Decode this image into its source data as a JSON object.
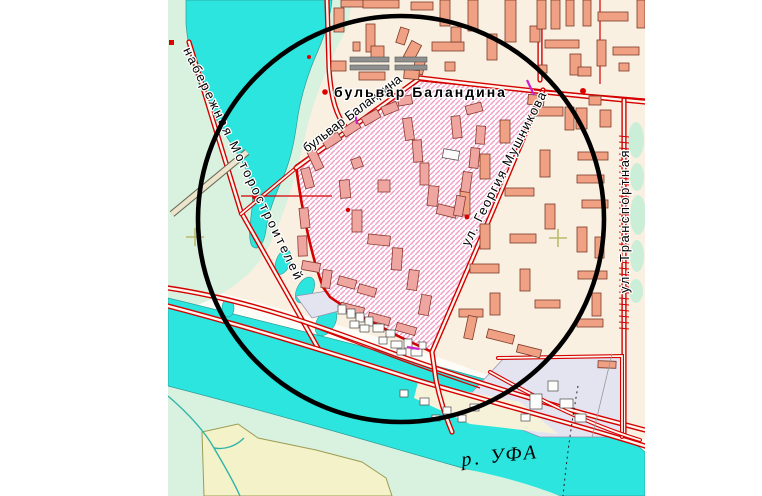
{
  "map": {
    "labels": {
      "embankment": "набережная Моторостроителей",
      "balandina_diagonal": "бульвар Баландина",
      "balandina_horizontal": "бульвар Баландина",
      "mushnikova": "ул. Георгия Мушникова",
      "transportnaya": "ул. Транспортная",
      "river": "р. УФА"
    },
    "colors": {
      "water": "#2BE5DE",
      "park_green": "#D9F1DF",
      "urban_cream": "#FAF0E1",
      "building_salmon": "#F0A183",
      "building_pink_zone": "#EFA6A0",
      "hatch_stripe_pink": "#F2A0C8",
      "selection_border_red": "#D40000",
      "road_red": "#D40000",
      "industrial_lavender": "#E4E3F0",
      "field_yellow": "#F4F2C8",
      "selection_circle": "#000000"
    },
    "buildings": {
      "salmon": [
        [
          334,
          8,
          10,
          24,
          0
        ],
        [
          341,
          0,
          28,
          7,
          0
        ],
        [
          363,
          0,
          36,
          8,
          0
        ],
        [
          366,
          24,
          9,
          28,
          0
        ],
        [
          371,
          46,
          13,
          13,
          0
        ],
        [
          353,
          42,
          7,
          9,
          0
        ],
        [
          331,
          61,
          15,
          10,
          0
        ],
        [
          359,
          72,
          26,
          8,
          0
        ],
        [
          398,
          28,
          9,
          16,
          18
        ],
        [
          407,
          42,
          11,
          18,
          28
        ],
        [
          414,
          60,
          10,
          14,
          12
        ],
        [
          404,
          70,
          15,
          9,
          5
        ],
        [
          411,
          2,
          22,
          8,
          0
        ],
        [
          440,
          0,
          10,
          26,
          0
        ],
        [
          432,
          42,
          32,
          9,
          0
        ],
        [
          451,
          27,
          10,
          15,
          0
        ],
        [
          468,
          0,
          10,
          31,
          0
        ],
        [
          487,
          34,
          10,
          26,
          0
        ],
        [
          505,
          0,
          11,
          42,
          0
        ],
        [
          530,
          26,
          10,
          16,
          0
        ],
        [
          445,
          62,
          10,
          9,
          0
        ],
        [
          537,
          0,
          9,
          29,
          0
        ],
        [
          551,
          0,
          9,
          29,
          0
        ],
        [
          566,
          0,
          8,
          26,
          0
        ],
        [
          583,
          0,
          8,
          26,
          0
        ],
        [
          598,
          12,
          30,
          9,
          0
        ],
        [
          637,
          0,
          8,
          28,
          0
        ],
        [
          545,
          40,
          34,
          8,
          0
        ],
        [
          597,
          40,
          9,
          26,
          0
        ],
        [
          613,
          47,
          26,
          8,
          0
        ],
        [
          539,
          65,
          8,
          8,
          0
        ],
        [
          619,
          63,
          10,
          8,
          0
        ],
        [
          570,
          54,
          11,
          21,
          0
        ],
        [
          578,
          67,
          13,
          9,
          0
        ],
        [
          528,
          95,
          16,
          10,
          5
        ],
        [
          534,
          107,
          29,
          9,
          0
        ],
        [
          565,
          107,
          9,
          23,
          0
        ],
        [
          589,
          96,
          12,
          9,
          0
        ],
        [
          576,
          108,
          11,
          21,
          0
        ],
        [
          600,
          110,
          11,
          17,
          0
        ],
        [
          500,
          120,
          10,
          23,
          0
        ],
        [
          480,
          154,
          10,
          25,
          0
        ],
        [
          540,
          150,
          10,
          27,
          0
        ],
        [
          578,
          152,
          30,
          8,
          0
        ],
        [
          577,
          175,
          27,
          8,
          0
        ],
        [
          582,
          200,
          26,
          8,
          0
        ],
        [
          577,
          227,
          10,
          25,
          0
        ],
        [
          595,
          237,
          9,
          21,
          0
        ],
        [
          578,
          271,
          29,
          8,
          0
        ],
        [
          592,
          293,
          9,
          23,
          0
        ],
        [
          577,
          319,
          26,
          8,
          0
        ],
        [
          460,
          189,
          10,
          26,
          0
        ],
        [
          505,
          188,
          29,
          8,
          0
        ],
        [
          545,
          204,
          10,
          25,
          0
        ],
        [
          480,
          224,
          10,
          25,
          0
        ],
        [
          510,
          234,
          26,
          9,
          0
        ],
        [
          470,
          264,
          29,
          9,
          0
        ],
        [
          520,
          269,
          10,
          22,
          0
        ],
        [
          490,
          293,
          10,
          22,
          0
        ],
        [
          535,
          300,
          25,
          8,
          0
        ],
        [
          459,
          309,
          24,
          8,
          0
        ],
        [
          466,
          316,
          9,
          23,
          12
        ],
        [
          487,
          332,
          27,
          9,
          14
        ],
        [
          517,
          347,
          24,
          8,
          14
        ],
        [
          598,
          361,
          18,
          7,
          2
        ]
      ],
      "pink": [
        [
          303,
          168,
          9,
          20,
          -15
        ],
        [
          311,
          150,
          9,
          20,
          -25
        ],
        [
          323,
          136,
          18,
          9,
          -33
        ],
        [
          342,
          124,
          18,
          9,
          -33
        ],
        [
          362,
          113,
          18,
          9,
          -30
        ],
        [
          382,
          104,
          16,
          9,
          -22
        ],
        [
          398,
          96,
          14,
          9,
          -10
        ],
        [
          404,
          118,
          9,
          22,
          -8
        ],
        [
          413,
          140,
          9,
          22,
          -4
        ],
        [
          420,
          163,
          9,
          22,
          0
        ],
        [
          428,
          186,
          10,
          20,
          6
        ],
        [
          437,
          206,
          20,
          10,
          14
        ],
        [
          455,
          196,
          9,
          20,
          10
        ],
        [
          462,
          172,
          9,
          20,
          8
        ],
        [
          470,
          148,
          9,
          20,
          6
        ],
        [
          476,
          126,
          9,
          18,
          4
        ],
        [
          452,
          116,
          9,
          22,
          -6
        ],
        [
          466,
          104,
          16,
          9,
          -15
        ],
        [
          300,
          208,
          9,
          20,
          -6
        ],
        [
          298,
          236,
          9,
          20,
          -2
        ],
        [
          302,
          262,
          18,
          9,
          10
        ],
        [
          322,
          270,
          9,
          18,
          8
        ],
        [
          338,
          278,
          18,
          9,
          16
        ],
        [
          358,
          286,
          18,
          9,
          16
        ],
        [
          340,
          305,
          24,
          8,
          14
        ],
        [
          368,
          315,
          22,
          8,
          15
        ],
        [
          396,
          325,
          20,
          8,
          16
        ],
        [
          352,
          210,
          10,
          22,
          0
        ],
        [
          368,
          235,
          22,
          10,
          6
        ],
        [
          392,
          248,
          10,
          22,
          4
        ],
        [
          408,
          270,
          10,
          20,
          8
        ],
        [
          420,
          295,
          10,
          20,
          10
        ],
        [
          378,
          180,
          12,
          12,
          0
        ],
        [
          340,
          180,
          10,
          18,
          -5
        ],
        [
          352,
          158,
          10,
          10,
          -20
        ]
      ],
      "grey": [
        [
          350,
          57,
          39,
          5,
          0
        ],
        [
          350,
          65,
          39,
          5,
          0
        ],
        [
          395,
          57,
          32,
          5,
          0
        ],
        [
          395,
          65,
          32,
          5,
          0
        ]
      ],
      "white": [
        [
          443,
          150,
          16,
          9,
          10
        ],
        [
          530,
          394,
          12,
          15,
          0
        ],
        [
          548,
          381,
          10,
          10,
          0
        ],
        [
          560,
          399,
          13,
          9,
          0
        ],
        [
          521,
          414,
          9,
          7,
          0
        ],
        [
          575,
          414,
          11,
          8,
          0
        ],
        [
          470,
          404,
          9,
          7,
          0
        ],
        [
          400,
          390,
          8,
          7,
          0
        ],
        [
          420,
          398,
          9,
          7,
          0
        ],
        [
          443,
          407,
          8,
          7,
          0
        ],
        [
          432,
          415,
          8,
          6,
          0
        ],
        [
          458,
          415,
          8,
          7,
          0
        ],
        [
          338,
          305,
          8,
          9,
          0
        ],
        [
          347,
          309,
          8,
          9,
          0
        ],
        [
          356,
          313,
          8,
          9,
          0
        ],
        [
          365,
          317,
          8,
          9,
          0
        ],
        [
          350,
          321,
          9,
          7,
          0
        ],
        [
          360,
          325,
          9,
          7,
          0
        ],
        [
          373,
          324,
          11,
          8,
          0
        ],
        [
          386,
          330,
          9,
          7,
          0
        ],
        [
          379,
          337,
          8,
          7,
          0
        ],
        [
          391,
          341,
          11,
          7,
          0
        ],
        [
          404,
          339,
          8,
          9,
          0
        ],
        [
          397,
          349,
          9,
          6,
          0
        ],
        [
          411,
          349,
          11,
          7,
          0
        ],
        [
          419,
          342,
          7,
          7,
          0
        ]
      ]
    }
  }
}
